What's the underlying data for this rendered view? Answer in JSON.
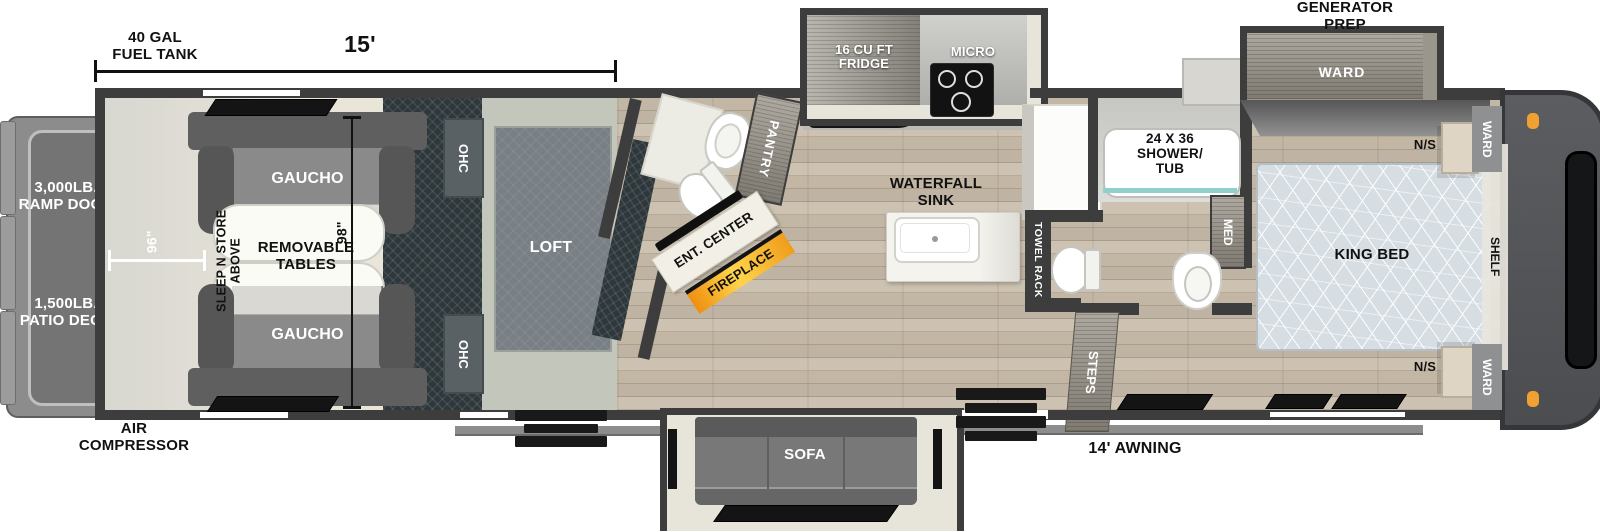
{
  "floorplan": {
    "exterior": {
      "fuel_tank": "40 GAL\nFUEL TANK",
      "ramp_door": "3,000LB.\nRAMP DOOR",
      "patio_deck": "1,500LB.\nPATIO DECK",
      "air_compressor": "AIR\nCOMPRESSOR",
      "generator_prep": "GENERATOR\nPREP",
      "awning": "14' AWNING"
    },
    "dimensions": {
      "garage_length": "15'",
      "rear_width": "96\"",
      "garage_depth": "98\""
    },
    "garage": {
      "gaucho_top": "GAUCHO",
      "gaucho_bottom": "GAUCHO",
      "removable_tables": "REMOVABLE\nTABLES",
      "sleep_n_store": "SLEEP N STORE\nABOVE"
    },
    "loft": {
      "label": "LOFT",
      "ohc_top": "OHC",
      "ohc_bottom": "OHC"
    },
    "half_bath": {
      "pantry": "PANTRY"
    },
    "living": {
      "ent_center": "ENT. CENTER",
      "fireplace": "FIREPLACE",
      "sofa": "SOFA",
      "steps": "STEPS"
    },
    "kitchen": {
      "fridge": "16 CU FT\nFRIDGE",
      "micro": "MICRO",
      "waterfall_sink": "WATERFALL\nSINK"
    },
    "bath": {
      "shower_tub": "24 X 36\nSHOWER/\nTUB",
      "med": "MED",
      "towel_rack": "TOWEL RACK"
    },
    "bedroom": {
      "king_bed": "KING BED",
      "ward_slide": "WARD",
      "ward_top": "WARD",
      "ward_bottom": "WARD",
      "ns_top": "N/S",
      "ns_bottom": "N/S",
      "shelf": "SHELF"
    },
    "colors": {
      "wall": "#3d3d3d",
      "garage_floor": "#e9e6d9",
      "wood_floor": "#c9beac",
      "treadplate": "#2e373b",
      "fireplace_orange": "#f59d1e",
      "marker_light": "#f0a132",
      "shower_glass": "#8fd0cb"
    }
  }
}
